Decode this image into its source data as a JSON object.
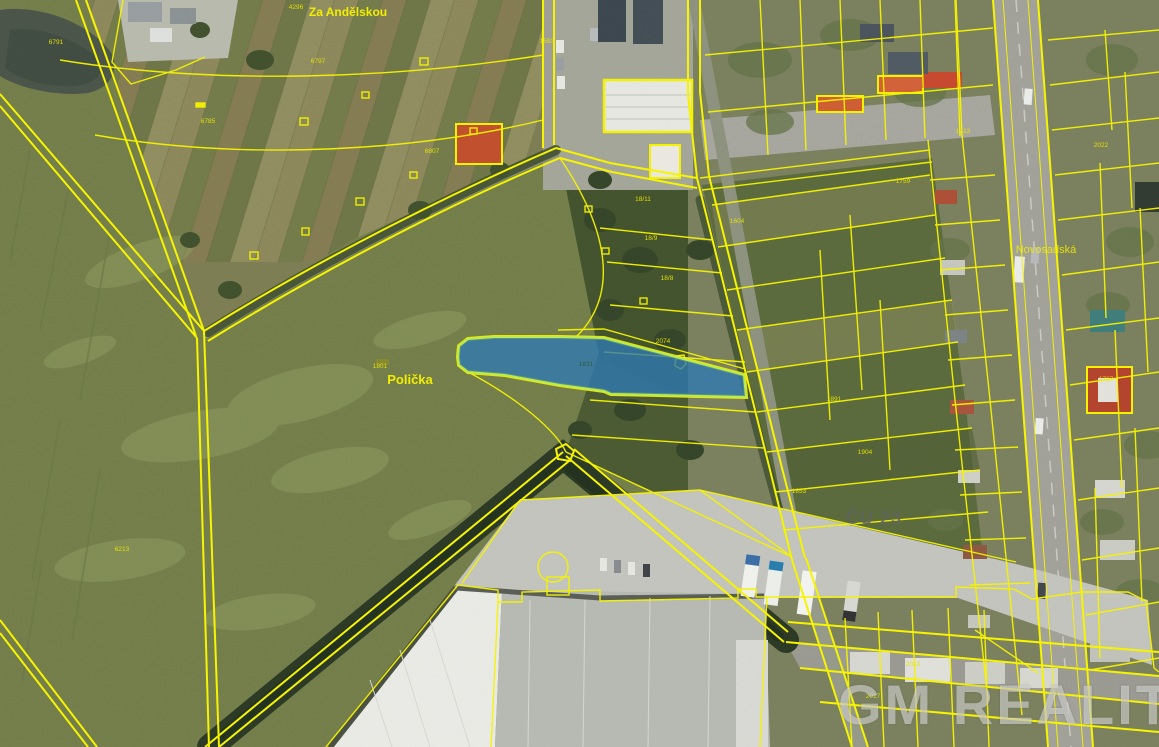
{
  "map": {
    "type": "cadastral-aerial-map",
    "place_labels": [
      {
        "text": "Za Andělskou",
        "x": 348,
        "y": 16,
        "size": 12
      },
      {
        "text": "Polička",
        "x": 410,
        "y": 384,
        "size": 13
      }
    ],
    "street_labels": [
      {
        "text": "Novosadská",
        "x": 1046,
        "y": 253,
        "size": 11
      }
    ],
    "watermark": {
      "brand": "GM REALITY",
      "secondary": "ČU 23"
    },
    "highlight_parcel": {
      "number": "1831",
      "label_x": 586,
      "label_y": 366
    },
    "parcel_numbers": [
      {
        "text": "6791",
        "x": 56,
        "y": 44
      },
      {
        "text": "4296",
        "x": 296,
        "y": 9
      },
      {
        "text": "6785",
        "x": 208,
        "y": 123
      },
      {
        "text": "6797",
        "x": 318,
        "y": 63
      },
      {
        "text": "6807",
        "x": 432,
        "y": 153
      },
      {
        "text": "6213",
        "x": 122,
        "y": 551
      },
      {
        "text": "1801",
        "x": 380,
        "y": 368
      },
      {
        "text": "2074",
        "x": 663,
        "y": 343
      },
      {
        "text": "1593",
        "x": 547,
        "y": 43
      },
      {
        "text": "18/11",
        "x": 643,
        "y": 201
      },
      {
        "text": "18/9",
        "x": 651,
        "y": 240
      },
      {
        "text": "18/8",
        "x": 667,
        "y": 280
      },
      {
        "text": "1604",
        "x": 737,
        "y": 223
      },
      {
        "text": "1891",
        "x": 834,
        "y": 401
      },
      {
        "text": "1904",
        "x": 865,
        "y": 454
      },
      {
        "text": "1853",
        "x": 799,
        "y": 493
      },
      {
        "text": "1759",
        "x": 903,
        "y": 183
      },
      {
        "text": "1713",
        "x": 963,
        "y": 133
      },
      {
        "text": "2022",
        "x": 1101,
        "y": 147
      },
      {
        "text": "1727",
        "x": 1106,
        "y": 381
      },
      {
        "text": "2013",
        "x": 913,
        "y": 666
      },
      {
        "text": "2017",
        "x": 873,
        "y": 698
      }
    ],
    "colors": {
      "cadastral_line": "#f6f400",
      "highlight_fill": "#2e79b4",
      "highlight_stroke": "#b9ea4e",
      "place_label": "#f2ee00",
      "parcel_number": "#e8e400",
      "watermark": "rgba(232,232,228,0.55)",
      "watermark_secondary": "rgba(95,100,95,0.82)"
    }
  }
}
